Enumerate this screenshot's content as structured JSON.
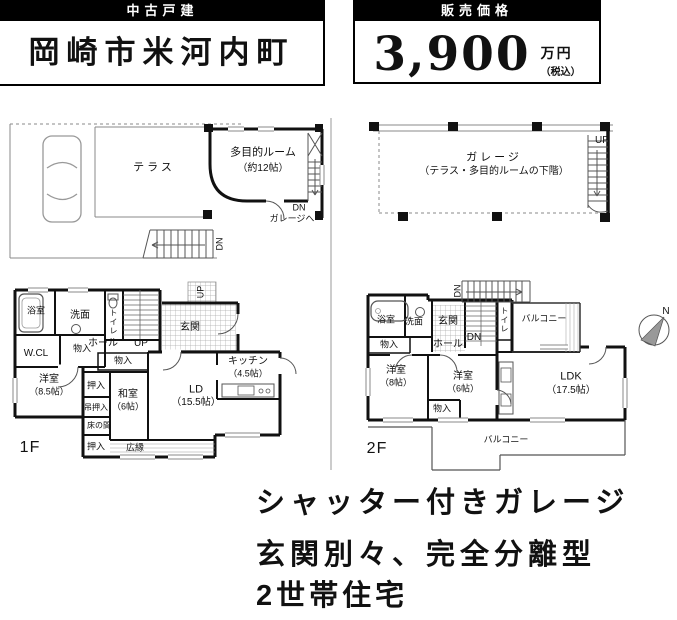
{
  "listing": {
    "type_label": "中古戸建",
    "address": "岡崎市米河内町"
  },
  "price": {
    "label": "販売価格",
    "amount": "3,900",
    "unit": "万円",
    "tax_note": "（税込）"
  },
  "terrace_plan": {
    "terrace": "テラス",
    "multipurpose_room": "多目的ルーム",
    "multipurpose_size": "（約12帖）",
    "dn": "DN",
    "to_garage": "ガレージへ",
    "stair_dn": "DN"
  },
  "garage_plan": {
    "name": "ガレージ",
    "note": "（テラス・多目的ルームの下階）",
    "up": "UP"
  },
  "floor1": {
    "label": "1F",
    "bath": "浴室",
    "wash": "洗面",
    "toilet": "トイレ",
    "wcl": "W.CL",
    "storage_small": "物入",
    "hall": "ホール",
    "up": "UP",
    "storage_wide": "物入",
    "entrance": "玄関",
    "porch_up": "UP",
    "kitchen": "キッチン",
    "kitchen_size": "（4.5帖）",
    "ld": "LD",
    "ld_size": "（15.5帖）",
    "western_room": "洋室",
    "western_room_size": "（8.5帖）",
    "oshiire_top": "押入",
    "japanese_room": "和室",
    "japanese_room_size": "（6帖）",
    "hanging_closet": "吊押入",
    "tokonoma": "床の間",
    "oshiire_bottom": "押入",
    "engawa": "広縁"
  },
  "floor2": {
    "label": "2F",
    "bath": "浴室",
    "wash": "洗面",
    "storage_left": "物入",
    "entrance": "玄関",
    "stair_dn": "DN",
    "outer_dn": "DN",
    "toilet": "トイレ",
    "hall": "ホール",
    "balcony_top": "バルコニー",
    "western_room_8": "洋室",
    "western_room_8_size": "（8帖）",
    "western_room_6": "洋室",
    "western_room_6_size": "（6帖）",
    "ldk": "LDK",
    "ldk_size": "（17.5帖）",
    "storage_mid": "物入",
    "balcony_bottom": "バルコニー",
    "compass_n": "N"
  },
  "footer": {
    "line1": "シャッター付きガレージ",
    "line2": "玄関別々、完全分離型",
    "line3": "2世帯住宅"
  }
}
